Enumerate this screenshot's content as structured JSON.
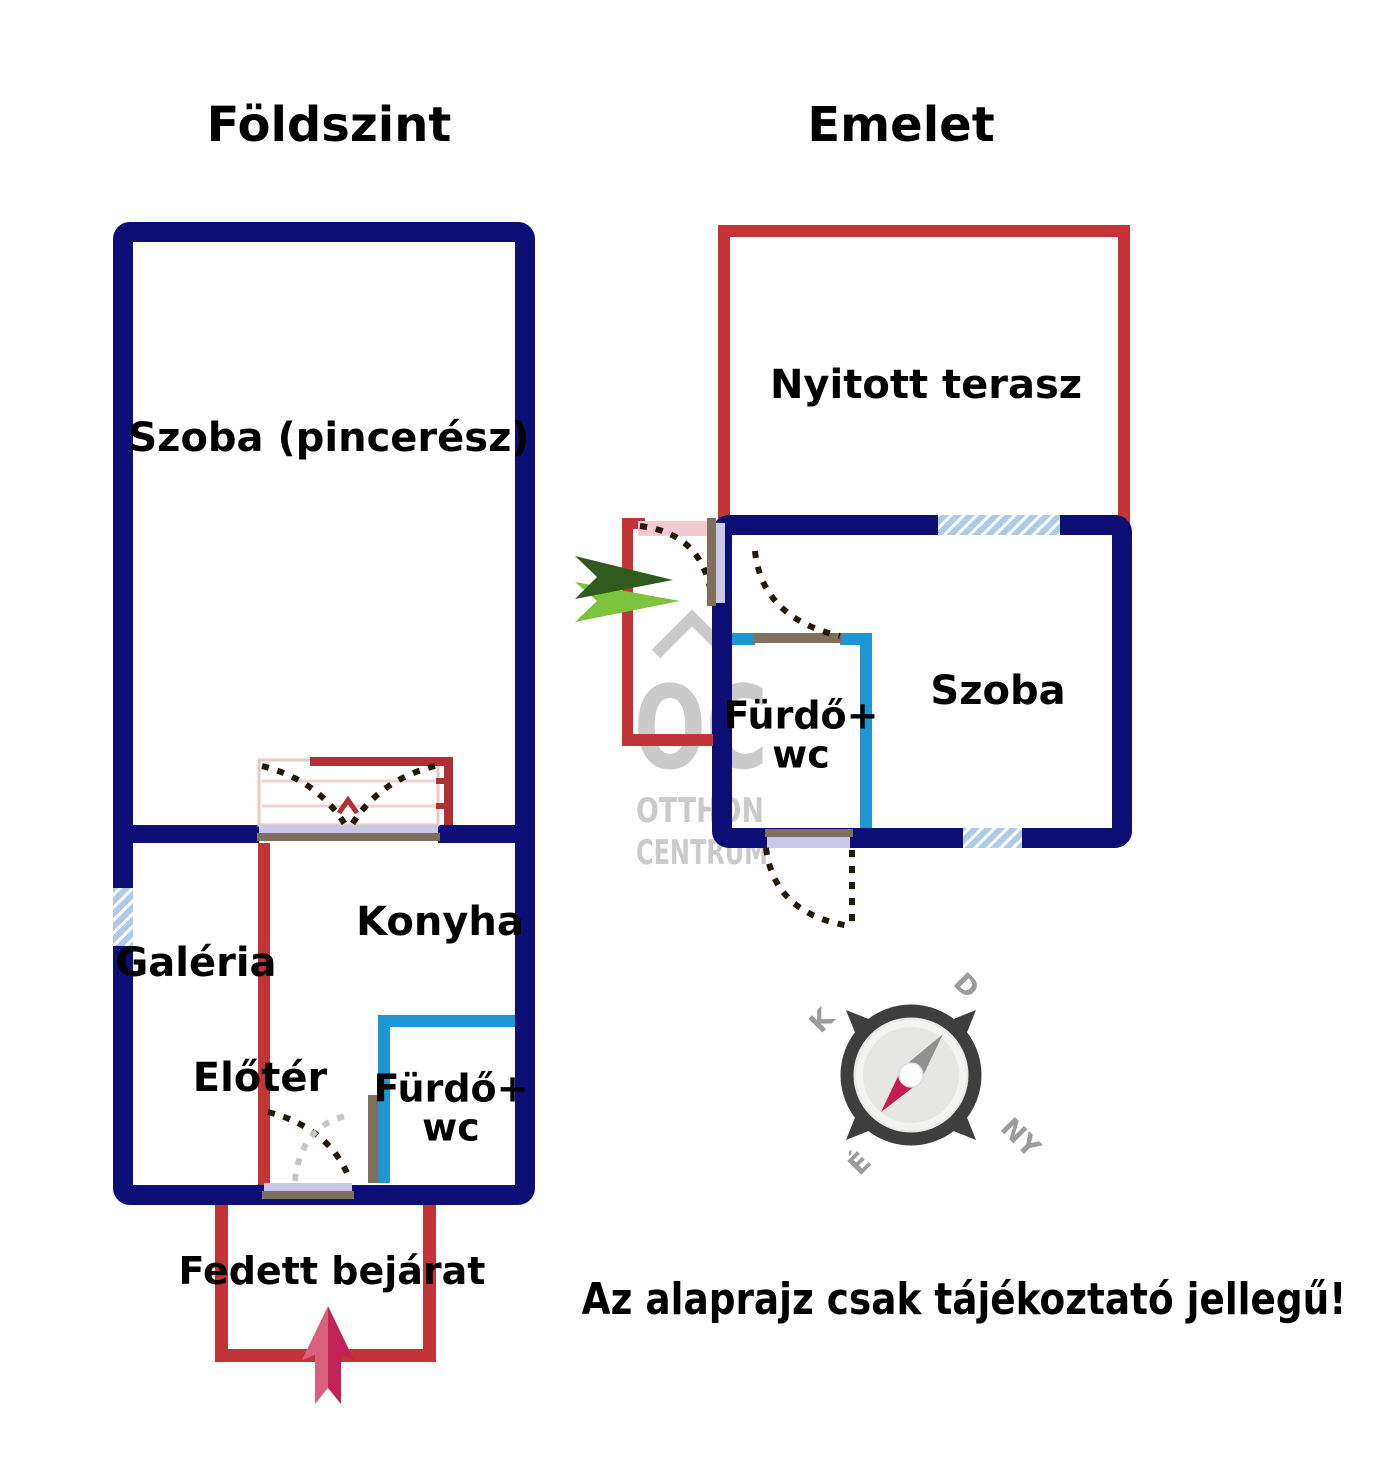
{
  "floors": {
    "ground": {
      "title": "Földszint",
      "rooms": {
        "szoba": "Szoba (pincerész)",
        "galeria": "Galéria",
        "konyha": "Konyha",
        "eloter": "Előtér",
        "furdo_line1": "Fürdő+",
        "furdo_line2": "wc"
      },
      "entrance_label": "Fedett bejárat"
    },
    "upper": {
      "title": "Emelet",
      "rooms": {
        "terasz": "Nyitott terasz",
        "szoba": "Szoba",
        "furdo_line1": "Fürdő+",
        "furdo_line2": "wc"
      }
    }
  },
  "compass": {
    "south": "D",
    "east": "K",
    "north": "É",
    "west": "NY"
  },
  "watermark": {
    "logo": "OC",
    "line1": "OTTHON",
    "line2": "CENTRUM"
  },
  "disclaimer": "Az alaprajz csak tájékoztató jellegű!",
  "colors": {
    "navy": "#0d0d76",
    "red": "#c23436",
    "railing": "#b03034",
    "blue": "#1e96d4",
    "windowblue": "#abcbe9",
    "lavender": "#c9c8e6",
    "jamb": "#7e6f5e",
    "dash": "#241806",
    "dashgray": "#c9c4be",
    "pinkleaf": "#f3cad1",
    "stairpink": "#eec6c6",
    "stairline": "#f2d0d0",
    "watermark": "#c8c8c8",
    "greendark": "#2f5c1e",
    "greenlight": "#7dc33e",
    "arrowlight": "#db6080",
    "arrowdark": "#c22257",
    "compassdark": "#3e3e3e",
    "compassinner": "#e9e9e7",
    "compasslight": "#f3f3f1",
    "compassdisc": "#e6e6e4",
    "compasslabel": "#9c9c9c",
    "needlegray": "#909090",
    "needlered": "#c41d55"
  }
}
